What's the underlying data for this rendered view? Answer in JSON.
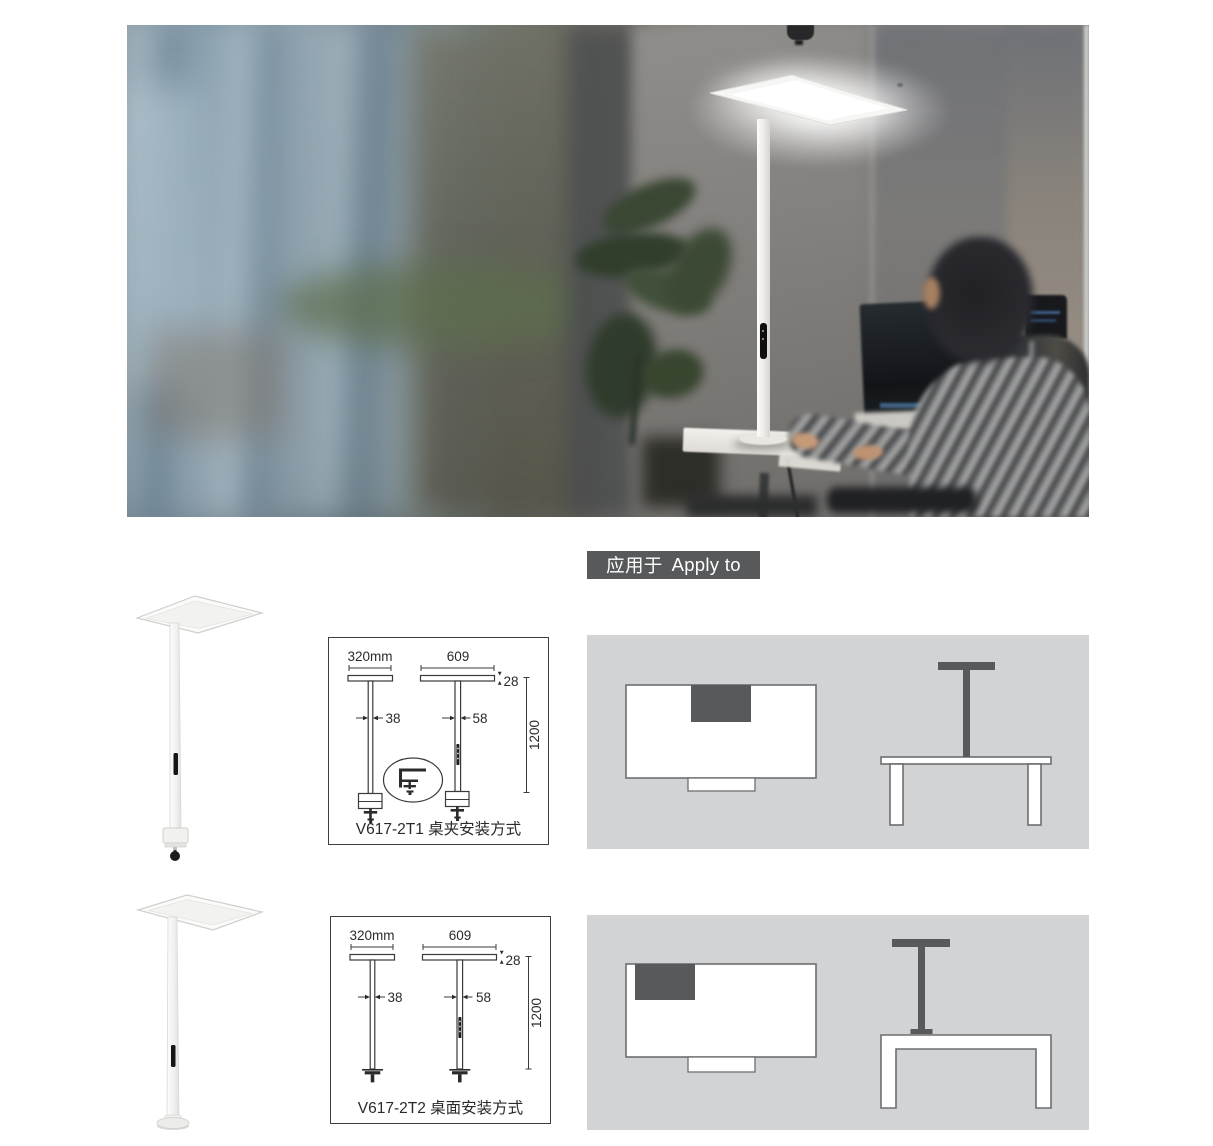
{
  "badge": {
    "zh": "应用于",
    "en": "Apply to"
  },
  "palette": {
    "badge_bg": "#58595b",
    "panel_bg": "#d2d3d4",
    "diagram_dark": "#58595b",
    "line_color": "#3a3a3c"
  },
  "products": [
    {
      "caption": "V617-2T1 桌夹安装方式",
      "dims": {
        "head_side_width": "320mm",
        "head_front_width": "609",
        "head_thickness": "28",
        "pole_side_width": "38",
        "pole_front_width": "58",
        "pole_height": "1200"
      }
    },
    {
      "caption": "V617-2T2 桌面安装方式",
      "dims": {
        "head_side_width": "320mm",
        "head_front_width": "609",
        "head_thickness": "28",
        "pole_side_width": "38",
        "pole_front_width": "58",
        "pole_height": "1200"
      }
    }
  ]
}
